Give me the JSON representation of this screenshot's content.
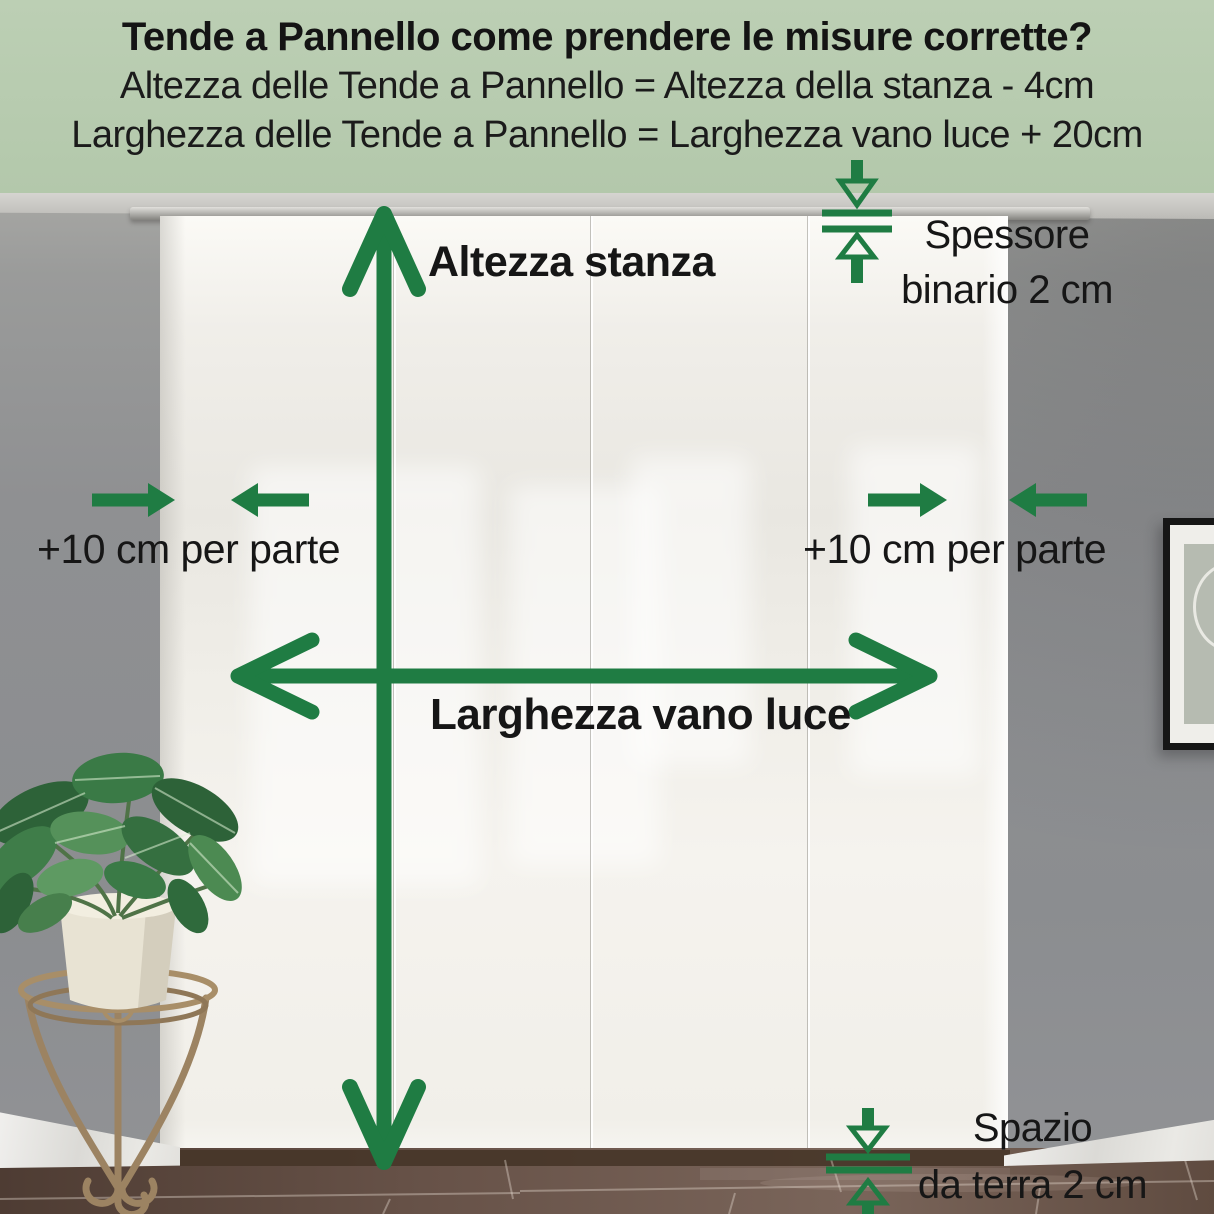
{
  "header": {
    "title": "Tende a Pannello come prendere le misure corrette?",
    "formula_height": "Altezza delle Tende a Pannello = Altezza della stanza - 4cm",
    "formula_width": "Larghezza delle Tende a Pannello = Larghezza vano luce + 20cm"
  },
  "diagram": {
    "room_height": {
      "label": "Altezza stanza"
    },
    "opening_width": {
      "label": "Larghezza vano luce"
    },
    "allowance_left": {
      "label": "+10 cm per parte"
    },
    "allowance_right": {
      "label": "+10 cm per parte"
    },
    "rail_thickness": {
      "line1": "Spessore",
      "line2": "binario 2 cm"
    },
    "floor_gap": {
      "line1": "Spazio",
      "line2": "da terra 2 cm"
    }
  },
  "colors": {
    "accent_green": "#1f7c43",
    "header_bg": "#b5c9ad",
    "text_dark": "#161616",
    "curtain_white": "#f2f0ea",
    "wall_gray": "#8f9092",
    "floor_brown": "#5e4a3f"
  }
}
